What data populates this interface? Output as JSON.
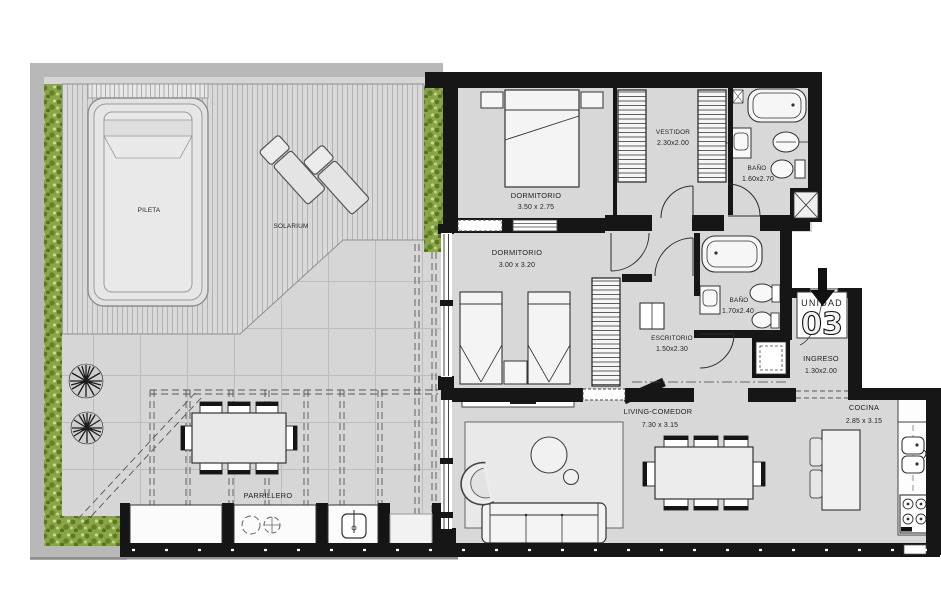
{
  "plan_title": "Planta Unidad 03",
  "unit": {
    "label": "UNIDAD",
    "number": "03"
  },
  "rooms": {
    "pileta": {
      "name": "PILETA",
      "dims": ""
    },
    "solarium": {
      "name": "SOLARIUM",
      "dims": ""
    },
    "dormitorio_principal": {
      "name": "DORMITORIO",
      "dims": "3.50 x 2.75"
    },
    "vestidor": {
      "name": "VESTIDOR",
      "dims": "2.30x2.00"
    },
    "bano_1": {
      "name": "BAÑO",
      "dims": "1.60x2.70"
    },
    "dormitorio_2": {
      "name": "DORMITORIO",
      "dims": "3.00 x 3.20"
    },
    "escritorio": {
      "name": "ESCRITORIO",
      "dims": "1.50x2.30"
    },
    "bano_2": {
      "name": "BAÑO",
      "dims": "1.70x2.40"
    },
    "ingreso": {
      "name": "INGRESO",
      "dims": "1.30x2.00"
    },
    "living_comedor": {
      "name": "LIVING-COMEDOR",
      "dims": "7.30 x 3.15"
    },
    "cocina": {
      "name": "COCINA",
      "dims": "2.85 x 3.15"
    },
    "parrillero": {
      "name": "PARRILLERO",
      "dims": ""
    }
  },
  "colors": {
    "wall_black": "#161616",
    "floor_gray": "#d8d8d8",
    "terrace_gray": "#d6d6d6",
    "border_gray": "#b8b8b8",
    "hedge_green": "#8aa644",
    "hedge_dark_green": "#5c7a22",
    "fixture_white": "#f4f4f4",
    "line_dark": "#333333"
  }
}
